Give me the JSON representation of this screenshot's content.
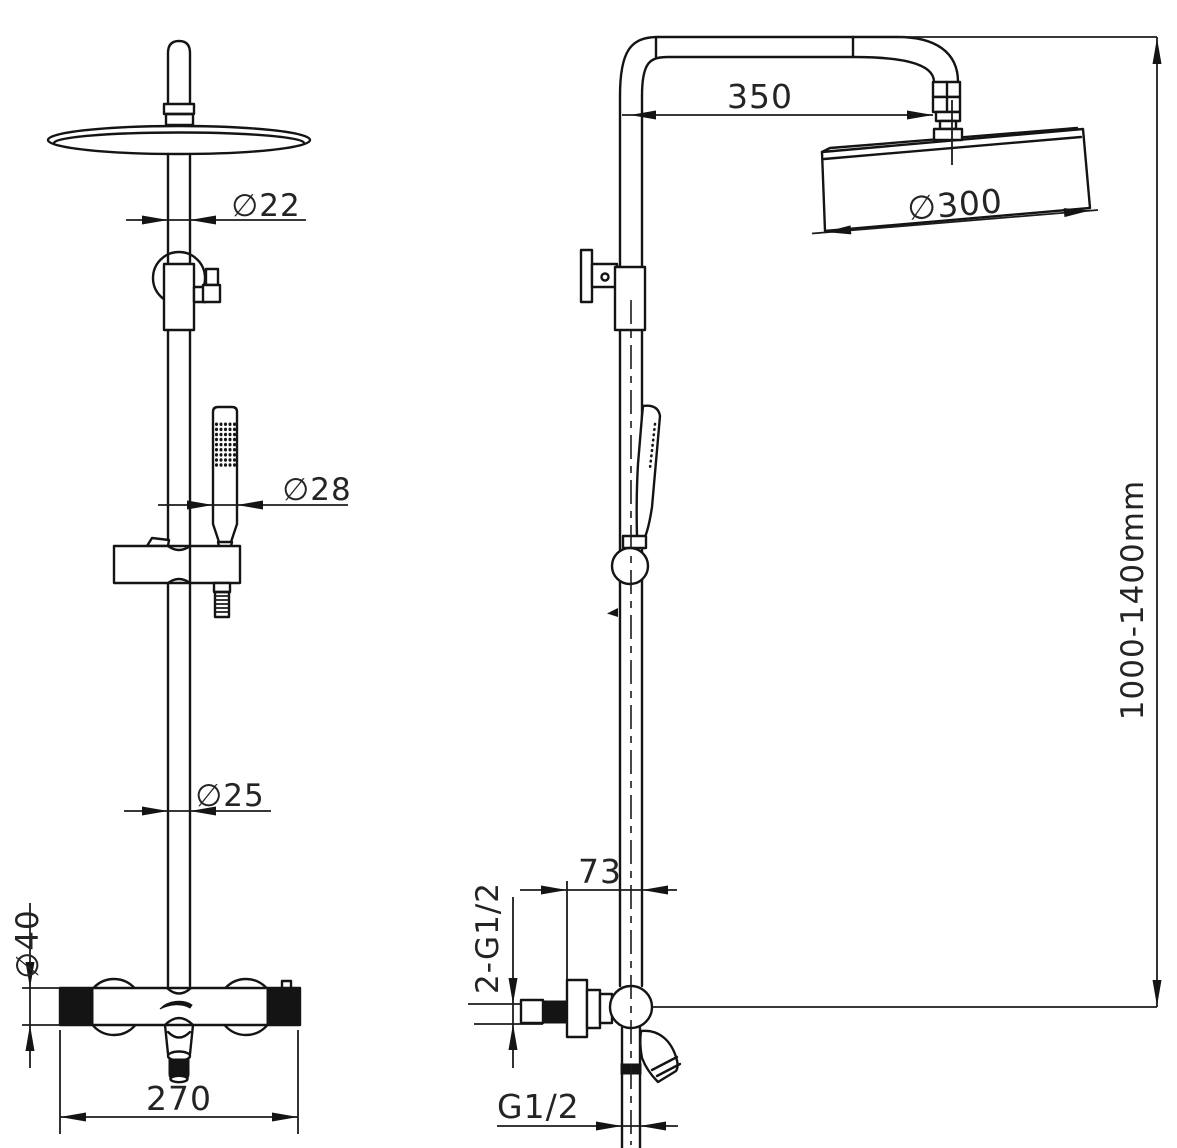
{
  "labels": {
    "pipe_diameter_top": "∅22",
    "hand_shower_diameter": "∅28",
    "riser_diameter": "∅25",
    "valve_diameter": "∅40",
    "valve_width": "270",
    "arm_projection": "350",
    "head_diameter": "∅300",
    "height_range": "1000-1400mm",
    "wall_offset": "73",
    "inlet_thread": "2-G1/2",
    "bottom_thread": "G1/2"
  }
}
